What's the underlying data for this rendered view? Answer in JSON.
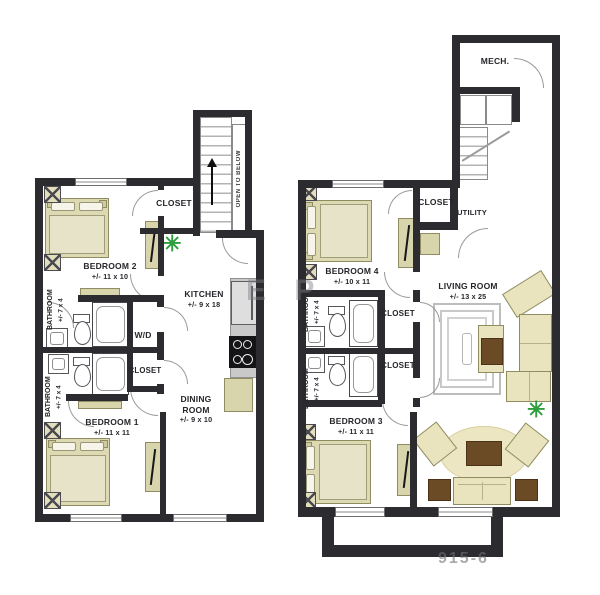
{
  "left_plan": {
    "stairs_note": "OPEN TO BELOW",
    "closet_top": "CLOSET",
    "bedroom2": {
      "name": "BEDROOM 2",
      "dims": "+/- 11 x 10"
    },
    "bathroom_top": {
      "name": "BATHROOM",
      "dims": "+/- 7 x 4"
    },
    "bathroom_bottom": {
      "name": "BATHROOM",
      "dims": "+/- 7 x 4"
    },
    "wd": "W/D",
    "closet_mid": "CLOSET",
    "kitchen": {
      "name": "KITCHEN",
      "dims": "+/- 9 x 18"
    },
    "dining": {
      "name": "DINING ROOM",
      "dims": "+/- 9 x 10"
    },
    "bedroom1": {
      "name": "BEDROOM 1",
      "dims": "+/- 11 x 11"
    }
  },
  "right_plan": {
    "mech": "MECH.",
    "closet_top": "CLOSET",
    "utility": "UTILITY",
    "bedroom4": {
      "name": "BEDROOM 4",
      "dims": "+/- 10 x 11"
    },
    "living": {
      "name": "LIVING ROOM",
      "dims": "+/- 13 x 25"
    },
    "bathroom_top": {
      "name": "BATHROOM",
      "dims": "+/- 7 x 4"
    },
    "bathroom_bottom": {
      "name": "BATHROOM",
      "dims": "+/- 7 x 4"
    },
    "closet_a": "CLOSET",
    "closet_b": "CLOSET",
    "bedroom3": {
      "name": "BEDROOM 3",
      "dims": "+/- 11 x 11"
    }
  },
  "watermarks": {
    "center": "E P",
    "bottom_right": "915-6"
  },
  "icons": {
    "plant": "✳"
  },
  "colors": {
    "wall": "#2b2b30",
    "furniture_tan": "#ddd9b3",
    "furniture_border": "#8f8c62",
    "accent_brown": "#6b4a26",
    "plant_green": "#2e9e3c",
    "counter_gray": "#c9c9c9"
  }
}
